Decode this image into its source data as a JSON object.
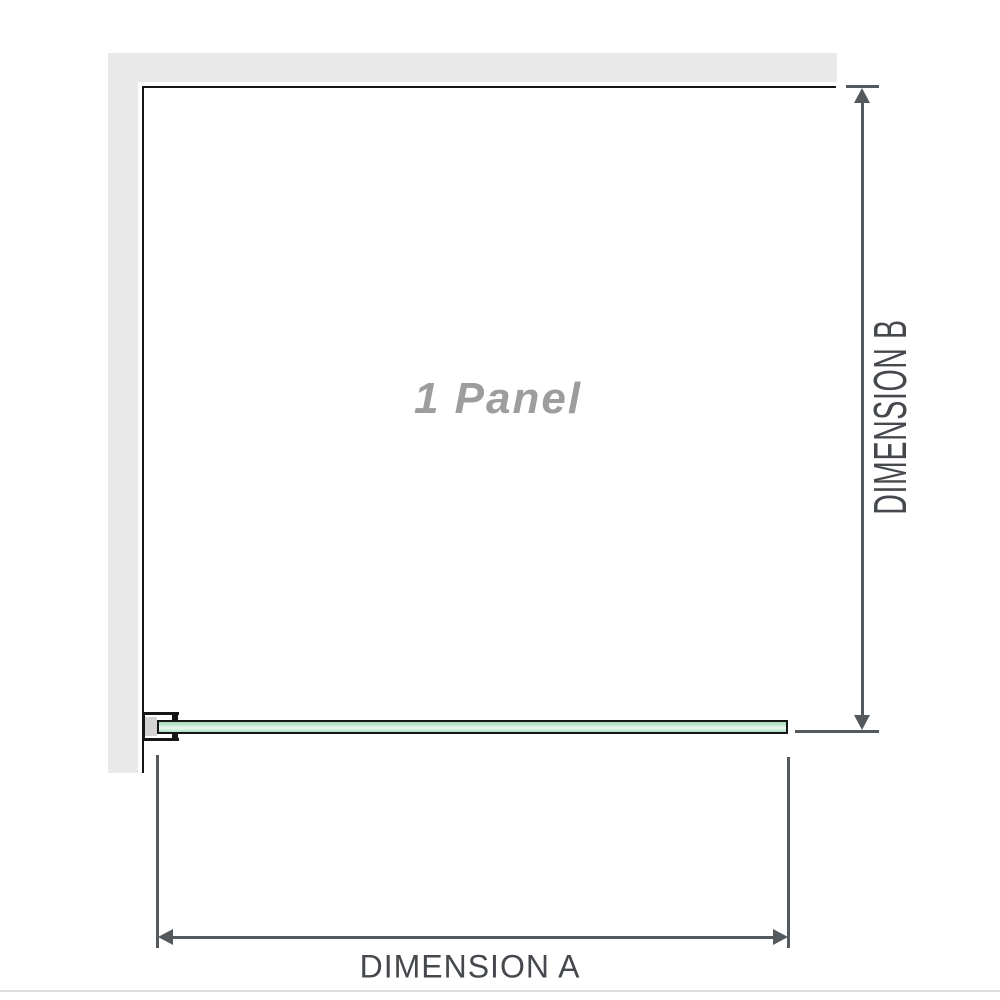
{
  "diagram": {
    "panel_label": "1 Panel",
    "dimension_a_label": "DIMENSION A",
    "dimension_b_label": "DIMENSION B",
    "panel_count": 1,
    "elements": {
      "wall": "l-shaped-wall",
      "glass_panel": "single-glass-panel-plan-view",
      "bracket": "wall-mount-clamp",
      "dimension_a": "horizontal-width-dimension",
      "dimension_b": "vertical-height-dimension"
    },
    "icons": [
      "arrow-up-icon",
      "arrow-down-icon",
      "arrow-left-icon",
      "arrow-right-icon"
    ]
  },
  "colors": {
    "background": "#ffffff",
    "wall_fill": "#e9e9e9",
    "wall_face_line": "#161616",
    "glass_outline": "#161616",
    "glass_green_dark": "#a9dabc",
    "glass_green_light": "#e9f7ef",
    "bracket_pad_fill": "#d3d3d3",
    "dimension_line": "#54595d",
    "dimension_text": "#45494d",
    "panel_label_text": "#9d9d9d",
    "separator_line": "#dcdcdc"
  }
}
